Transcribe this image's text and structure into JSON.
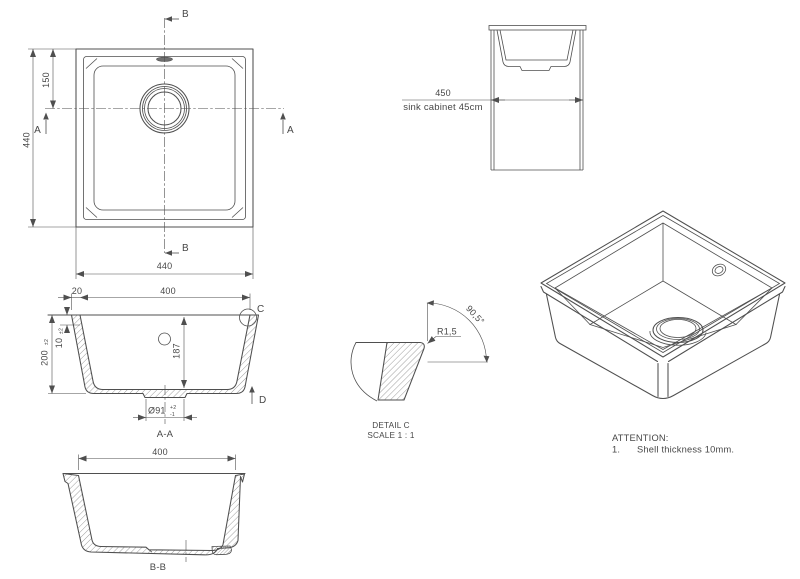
{
  "colors": {
    "line": "#4f4f4f",
    "text": "#474747",
    "background": "#ffffff"
  },
  "plan_view": {
    "dim_height": "440",
    "dim_drain_offset": "150",
    "dim_width": "440",
    "section_b_top": "B",
    "section_b_bottom": "B",
    "section_a_left": "A",
    "section_a_right": "A"
  },
  "cabinet_view": {
    "dim_width": "450",
    "note": "sink cabinet 45cm"
  },
  "section_aa": {
    "dim_rim_lip": "20",
    "dim_inner_width": "400",
    "dim_shell": "10",
    "dim_shell_tol": "±2",
    "dim_depth": "200",
    "dim_depth_tol": "±2",
    "dim_inner_depth": "187",
    "dim_drain_dia": "Ø91",
    "dim_drain_tol_plus": "+2",
    "dim_drain_tol_minus": "-1",
    "detail_label": "C",
    "direction_label": "D",
    "view_label": "A-A"
  },
  "section_bb": {
    "dim_inner_width": "400",
    "view_label": "B-B"
  },
  "detail_c": {
    "radius": "R1,5",
    "angle": "90,5°",
    "title": "DETAIL C",
    "scale": "SCALE 1 : 1"
  },
  "notes": {
    "heading": "ATTENTION:",
    "item_number": "1.",
    "item_text": "Shell thickness 10mm."
  }
}
